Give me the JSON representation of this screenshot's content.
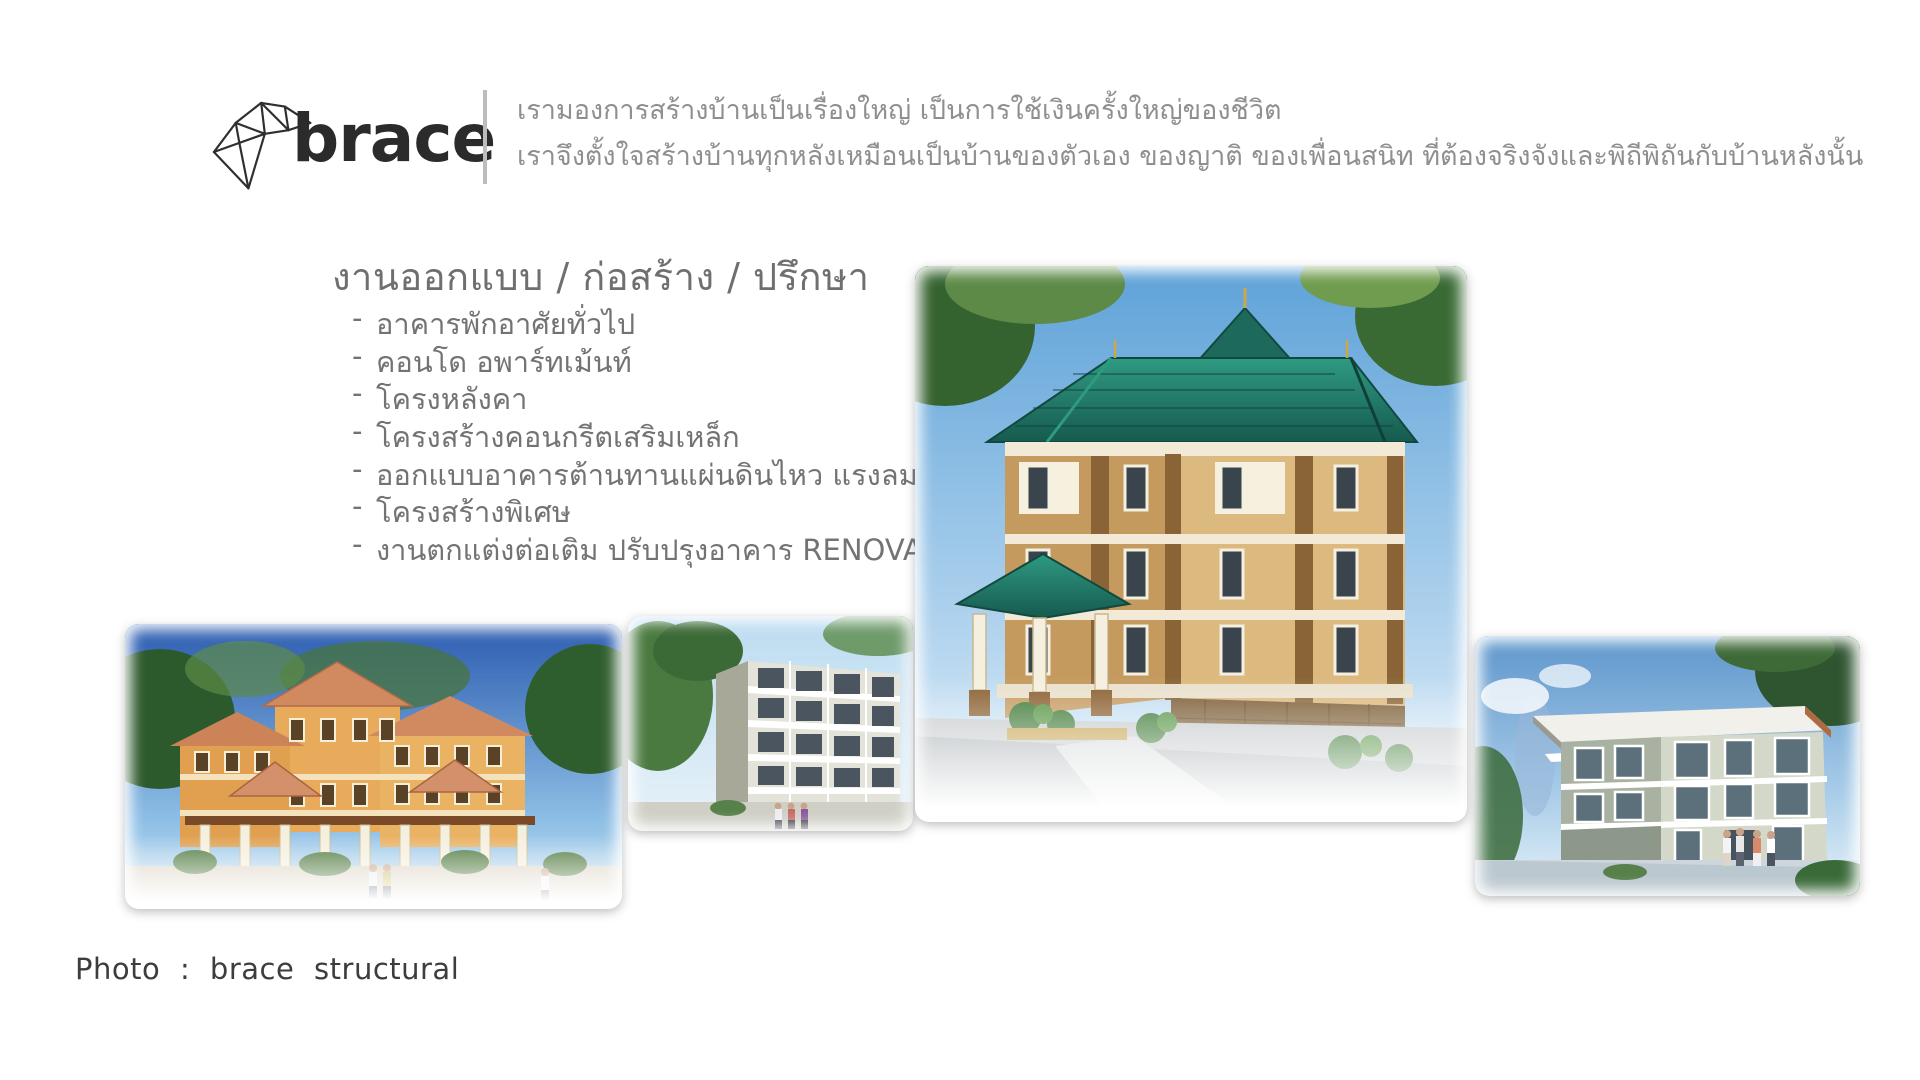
{
  "brand": {
    "logo_text": "brace",
    "tagline_line1": "เรามองการสร้างบ้านเป็นเรื่องใหญ่ เป็นการใช้เงินครั้งใหญ่ของชีวิต",
    "tagline_line2": "เราจึงตั้งใจสร้างบ้านทุกหลังเหมือนเป็นบ้านของตัวเอง ของญาติ ของเพื่อนสนิท ที่ต้องจริงจังและพิถีพิถันกับบ้านหลังนั้น"
  },
  "services": {
    "heading": "งานออกแบบ / ก่อสร้าง / ปรึกษา",
    "bullet": "-",
    "items": [
      "อาคารพักอาศัยทั่วไป",
      "คอนโด อพาร์ทเม้นท์",
      "โครงหลังคา",
      "โครงสร้างคอนกรีตเสริมเหล็ก",
      "ออกแบบอาคารต้านทานแผ่นดินไหว แรงลม",
      "โครงสร้างพิเศษ",
      "งานตกแต่งต่อเติม ปรับปรุงอาคาร RENOVATE"
    ]
  },
  "gallery": {
    "images": [
      {
        "name": "resort-apartment-rendering"
      },
      {
        "name": "grey-condo-rendering"
      },
      {
        "name": "teal-roof-building-rendering"
      },
      {
        "name": "modern-house-rendering"
      }
    ]
  },
  "footer": {
    "caption": "Photo : brace structural"
  },
  "colors": {
    "brand_dark": "#2b2b2b",
    "tagline_grey": "#8f8f8f",
    "text_grey": "#737373",
    "caption_dark": "#3d3d3d",
    "divider_grey": "#bdbdbd",
    "roof_teal": "#1e6e5e",
    "wall_tan": "#d8b478",
    "roof_terracotta": "#cf8a5f"
  }
}
